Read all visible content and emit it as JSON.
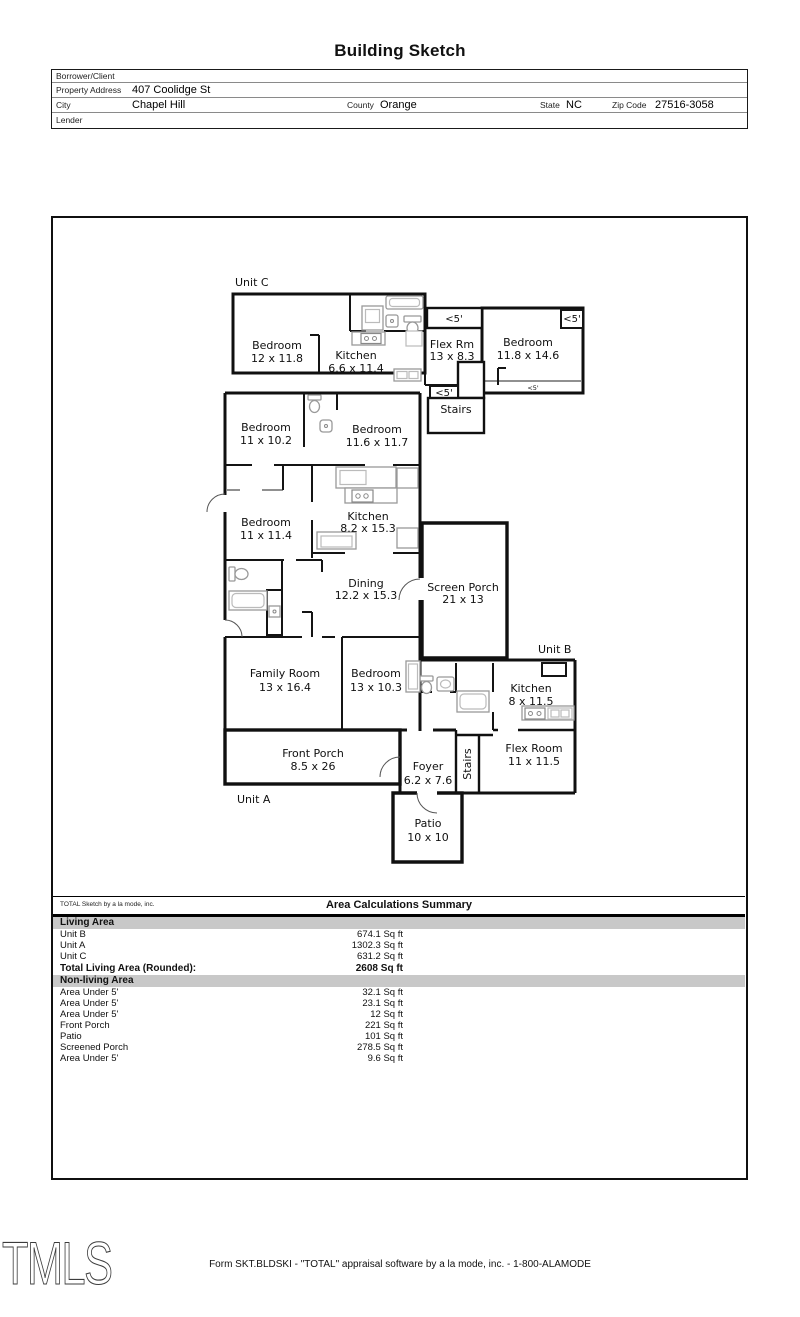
{
  "title": "Building Sketch",
  "header": {
    "borrower_label": "Borrower/Client",
    "property_label": "Property Address",
    "property_value": "407 Coolidge St",
    "city_label": "City",
    "city_value": "Chapel Hill",
    "county_label": "County",
    "county_value": "Orange",
    "state_label": "State",
    "state_value": "NC",
    "zip_label": "Zip Code",
    "zip_value": "27516-3058",
    "lender_label": "Lender"
  },
  "sketch": {
    "units": {
      "a": "Unit A",
      "b": "Unit B",
      "c": "Unit C"
    },
    "annotations": {
      "under5": "<5'"
    },
    "rooms": [
      {
        "name": "Bedroom",
        "dims": "12 x 11.8"
      },
      {
        "name": "Kitchen",
        "dims": "6.6 x 11.4"
      },
      {
        "name": "Flex Rm",
        "dims": "13 x 8.3"
      },
      {
        "name": "Bedroom",
        "dims": "11.8 x 14.6"
      },
      {
        "name": "Stairs",
        "dims": ""
      },
      {
        "name": "Bedroom",
        "dims": "11 x 10.2"
      },
      {
        "name": "Bedroom",
        "dims": "11.6 x 11.7"
      },
      {
        "name": "Bedroom",
        "dims": "11 x 11.4"
      },
      {
        "name": "Kitchen",
        "dims": "8.2 x 15.3"
      },
      {
        "name": "Dining",
        "dims": "12.2 x 15.3"
      },
      {
        "name": "Screen Porch",
        "dims": "21 x 13"
      },
      {
        "name": "Family Room",
        "dims": "13 x 16.4"
      },
      {
        "name": "Bedroom",
        "dims": "13 x 10.3"
      },
      {
        "name": "Kitchen",
        "dims": "8 x 11.5"
      },
      {
        "name": "Flex Room",
        "dims": "11 x 11.5"
      },
      {
        "name": "Front Porch",
        "dims": "8.5 x 26"
      },
      {
        "name": "Foyer",
        "dims": "6.2 x 7.6"
      },
      {
        "name": "Stairs",
        "dims": ""
      },
      {
        "name": "Patio",
        "dims": "10 x 10"
      }
    ]
  },
  "summary": {
    "branding": "TOTAL Sketch by a la mode, inc.",
    "title": "Area Calculations Summary",
    "living_header": "Living Area",
    "living_rows": [
      {
        "label": "Unit B",
        "value": "674.1 Sq ft"
      },
      {
        "label": "Unit A",
        "value": "1302.3 Sq ft"
      },
      {
        "label": "Unit C",
        "value": "631.2 Sq ft"
      }
    ],
    "total_label": "Total Living Area (Rounded):",
    "total_value": "2608 Sq ft",
    "nonliving_header": "Non-living Area",
    "nonliving_rows": [
      {
        "label": "Area Under 5'",
        "value": "32.1 Sq ft"
      },
      {
        "label": "Area Under 5'",
        "value": "23.1 Sq ft"
      },
      {
        "label": "Area Under 5'",
        "value": "12 Sq ft"
      },
      {
        "label": "Front Porch",
        "value": "221 Sq ft"
      },
      {
        "label": "Patio",
        "value": "101 Sq ft"
      },
      {
        "label": "Screened Porch",
        "value": "278.5 Sq ft"
      },
      {
        "label": "Area Under 5'",
        "value": "9.6 Sq ft"
      }
    ]
  },
  "footer": {
    "logo": "TMLS",
    "form_line": "Form SKT.BLDSKI - \"TOTAL\" appraisal software by a la mode, inc. - 1-800-ALAMODE"
  }
}
